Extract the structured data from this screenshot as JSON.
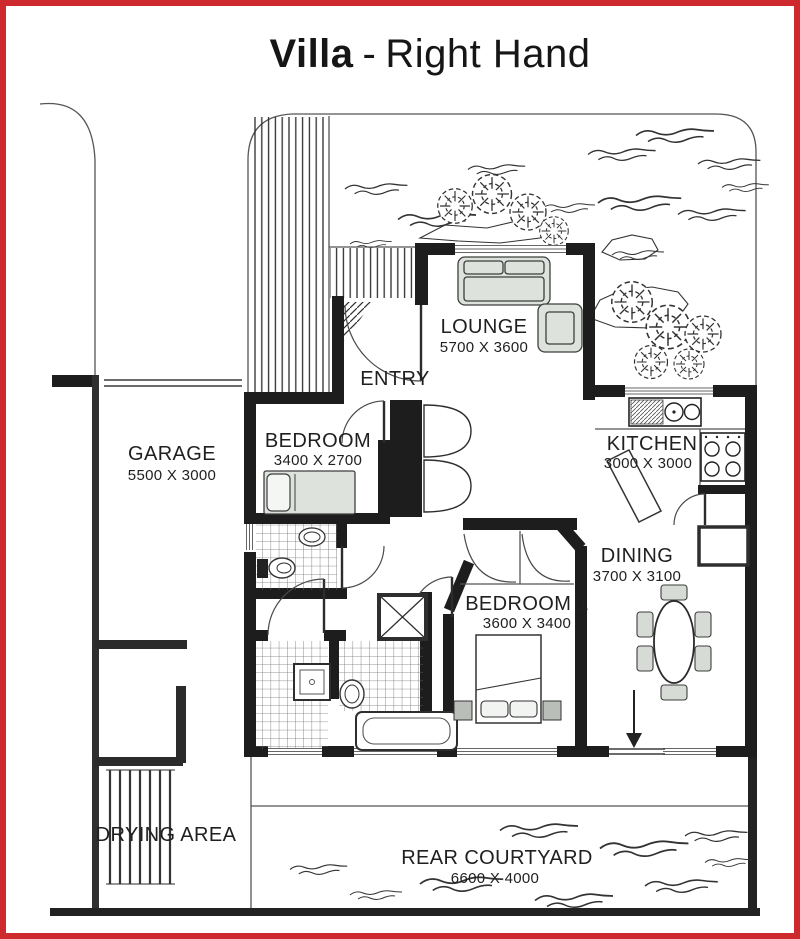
{
  "title": {
    "bold": "Villa",
    "sep": "-",
    "regular": "Right Hand"
  },
  "rooms": {
    "garage": {
      "name": "GARAGE",
      "dims": "5500 X 3000"
    },
    "lounge": {
      "name": "LOUNGE",
      "dims": "5700 X 3600"
    },
    "entry": {
      "name": "ENTRY"
    },
    "bedroom": {
      "name": "BEDROOM",
      "dims": "3400 X 2700"
    },
    "kitchen": {
      "name": "KITCHEN",
      "dims": "3000 X 3000"
    },
    "dining": {
      "name": "DINING",
      "dims": "3700 X 3100"
    },
    "bedroom1": {
      "name": "BEDROOM 1",
      "dims": "3600 X 3400"
    },
    "drying_area": {
      "name": "DRYING AREA"
    },
    "rear_courtyard": {
      "name": "REAR COURTYARD",
      "dims": "6600 X 4000"
    }
  },
  "colors": {
    "border": "#ce2a2e",
    "wall": "#1d1d1d",
    "furn": "#dde2dd",
    "chair": "#d6dbd6",
    "text": "#1f1f1f"
  }
}
